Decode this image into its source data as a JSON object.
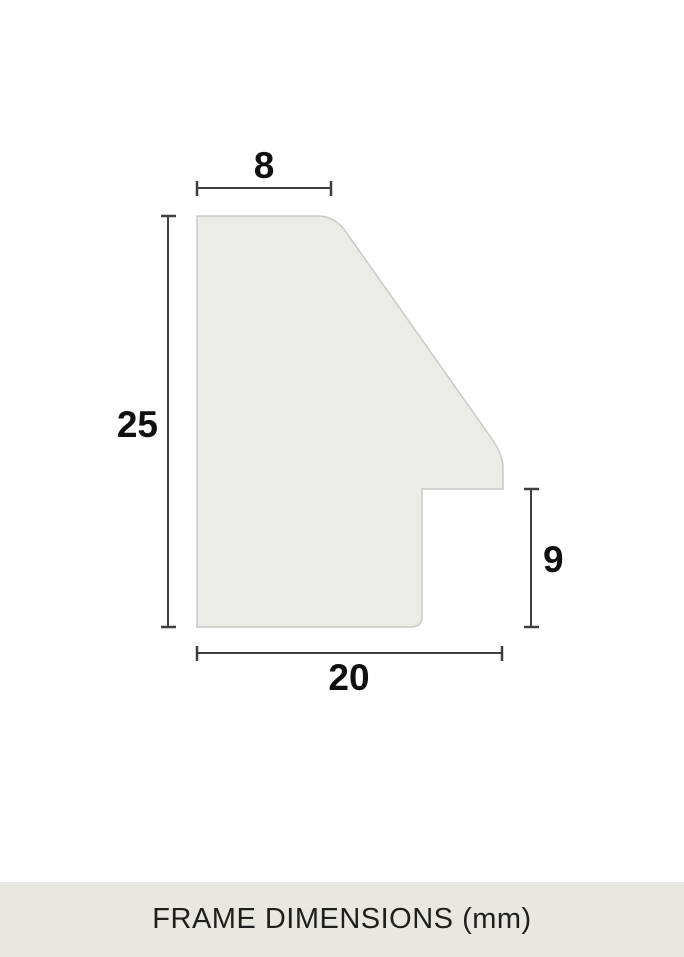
{
  "diagram": {
    "dimensions": {
      "top_width": "8",
      "left_height": "25",
      "rabbet_height": "9",
      "bottom_width": "20"
    }
  },
  "footer": {
    "label": "FRAME DIMENSIONS (mm)"
  },
  "colors": {
    "background": "#ffffff",
    "shape_fill": "#ebebe8",
    "shape_border": "#c9c9c6",
    "dimension_line": "#3f3f3f",
    "dimension_text": "#101010",
    "footer_bg": "#e8e7e2",
    "footer_text": "#1f1f1f"
  }
}
